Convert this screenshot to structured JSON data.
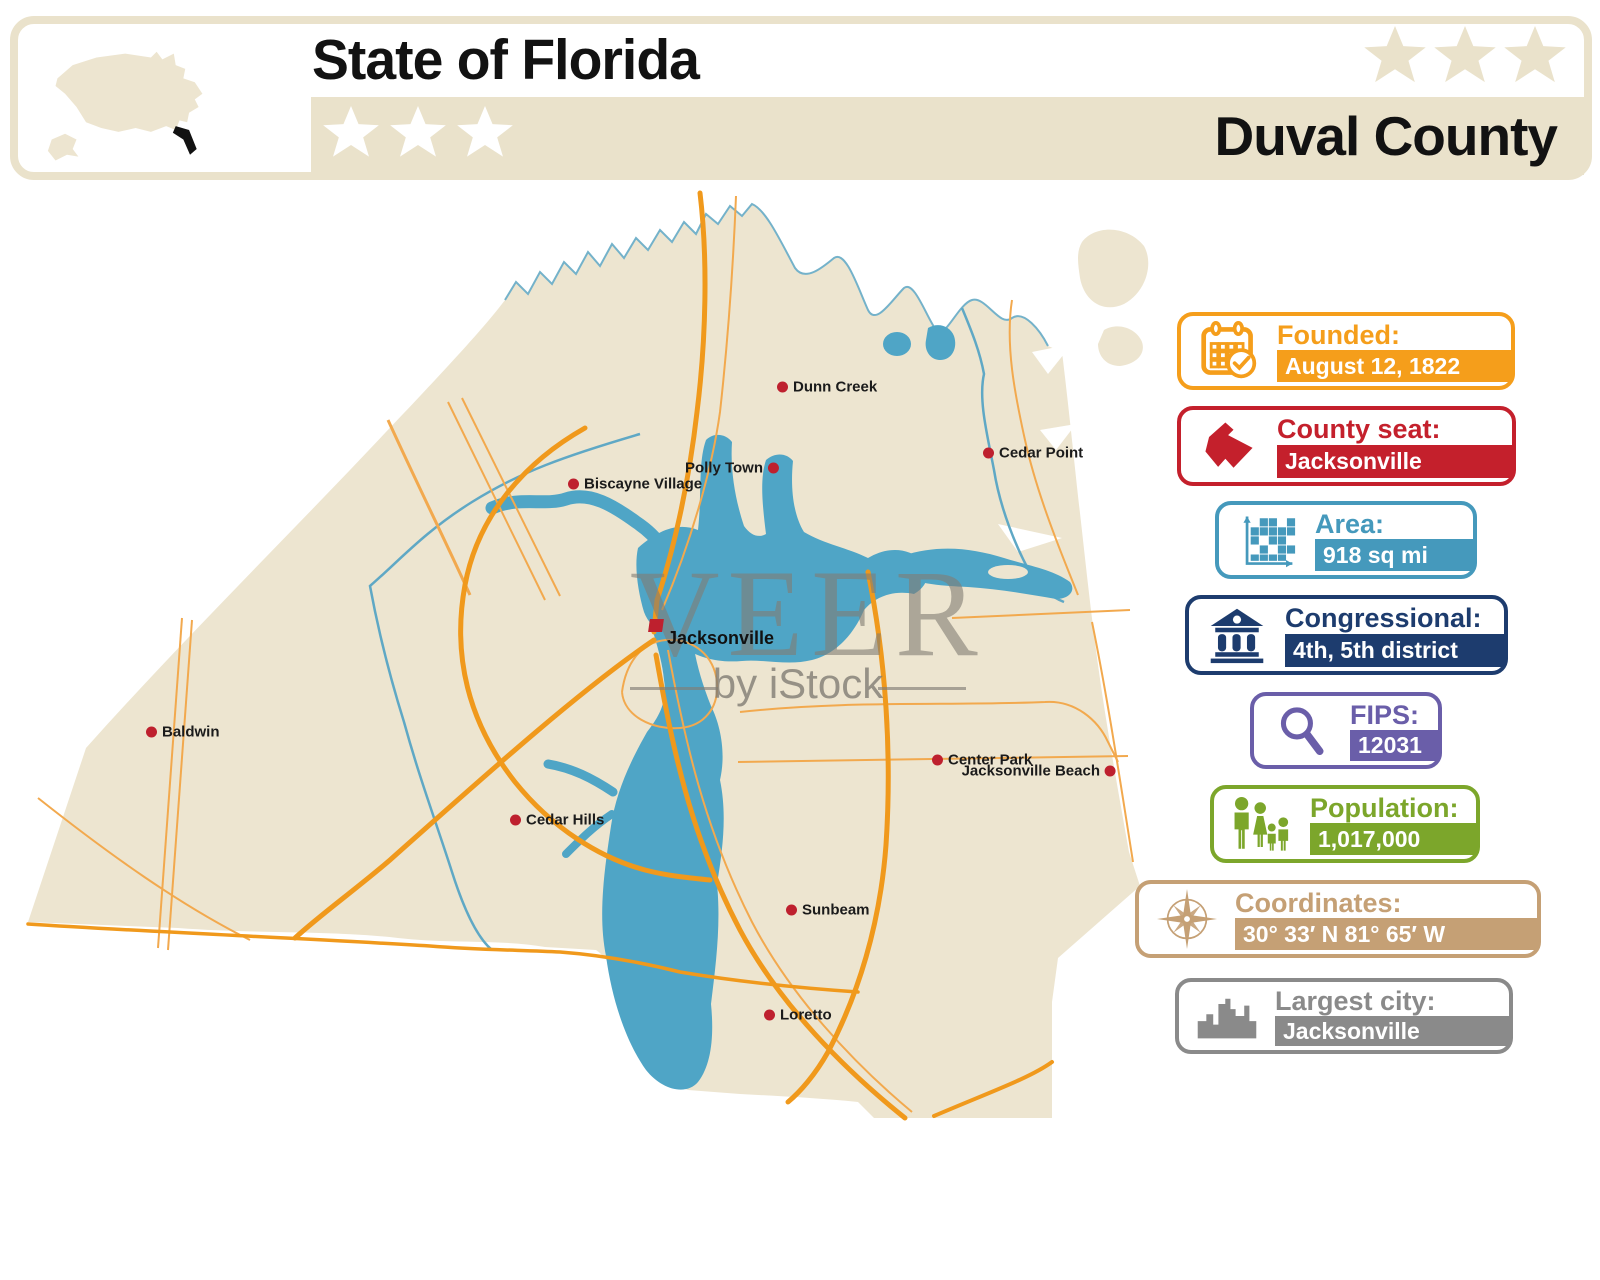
{
  "header": {
    "title": "State of Florida",
    "county_name": "Duval County",
    "stars_left": 3,
    "stars_right": 3
  },
  "watermark": {
    "brand": "VEER",
    "byline": "by iStock"
  },
  "map": {
    "city": {
      "name": "Jacksonville",
      "x": 656,
      "y": 631
    },
    "towns": [
      {
        "name": "Dunn Creek",
        "x": 783,
        "y": 387,
        "side": "right"
      },
      {
        "name": "Cedar Point",
        "x": 989,
        "y": 453,
        "side": "right"
      },
      {
        "name": "Polly Town",
        "x": 773,
        "y": 468,
        "side": "left"
      },
      {
        "name": "Biscayne Village",
        "x": 574,
        "y": 484,
        "side": "right"
      },
      {
        "name": "Baldwin",
        "x": 152,
        "y": 732,
        "side": "right"
      },
      {
        "name": "Center Park",
        "x": 938,
        "y": 760,
        "side": "right"
      },
      {
        "name": "Jacksonville Beach",
        "x": 1110,
        "y": 771,
        "side": "left"
      },
      {
        "name": "Cedar Hills",
        "x": 516,
        "y": 820,
        "side": "right"
      },
      {
        "name": "Sunbeam",
        "x": 792,
        "y": 910,
        "side": "right"
      },
      {
        "name": "Loretto",
        "x": 770,
        "y": 1015,
        "side": "right"
      }
    ]
  },
  "panels": [
    {
      "id": "founded",
      "label": "Founded:",
      "value": "August 12, 1822",
      "color": "#F59E1B",
      "icon": "calendar-icon",
      "x": 1177,
      "y": 312,
      "w": 338,
      "h": 78
    },
    {
      "id": "county-seat",
      "label": "County seat:",
      "value": "Jacksonville",
      "color": "#C4202C",
      "icon": "county-map-icon",
      "x": 1177,
      "y": 406,
      "w": 339,
      "h": 80
    },
    {
      "id": "area",
      "label": "Area:",
      "value": "918 sq mi",
      "color": "#4599BC",
      "icon": "grid-chart-icon",
      "x": 1215,
      "y": 501,
      "w": 262,
      "h": 78
    },
    {
      "id": "congressional",
      "label": "Congressional:",
      "value": "4th, 5th district",
      "color": "#1D3C6E",
      "icon": "bank-icon",
      "x": 1185,
      "y": 595,
      "w": 323,
      "h": 80
    },
    {
      "id": "fips",
      "label": "FIPS:",
      "value": "12031",
      "color": "#6A5EA9",
      "icon": "magnifier-icon",
      "x": 1250,
      "y": 692,
      "w": 192,
      "h": 77
    },
    {
      "id": "population",
      "label": "Population:",
      "value": "1,017,000",
      "color": "#7CA62B",
      "icon": "family-icon",
      "x": 1210,
      "y": 785,
      "w": 270,
      "h": 78
    },
    {
      "id": "coordinates",
      "label": "Coordinates:",
      "value": "30° 33′ N 81° 65′ W",
      "color": "#C5A075",
      "icon": "compass-icon",
      "x": 1135,
      "y": 880,
      "w": 406,
      "h": 78
    },
    {
      "id": "largest-city",
      "label": "Largest city:",
      "value": "Jacksonville",
      "color": "#8A8A8A",
      "icon": "city-skyline-icon",
      "x": 1175,
      "y": 978,
      "w": 338,
      "h": 76
    }
  ],
  "colors": {
    "land": "#EDE5D0",
    "water": "#4FA5C6",
    "creek": "#5FA8C5",
    "shore": "#74B2CA",
    "road": "#F0991C",
    "road_thin": "#F2A94E",
    "marker_red": "#BE202E",
    "header_beige": "#EAE2CB",
    "watermark_gray": "#817D74",
    "label_text": "#1B1B1B"
  }
}
